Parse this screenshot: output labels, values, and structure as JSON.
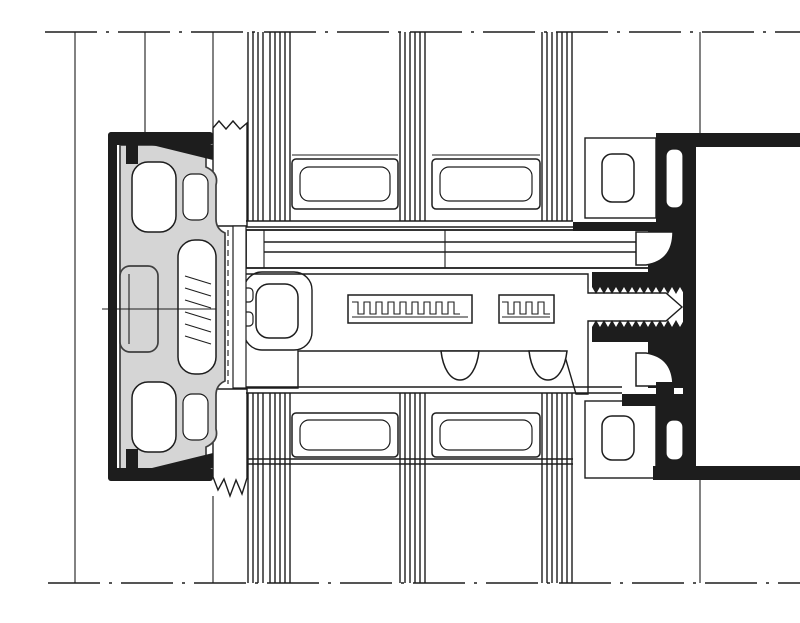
{
  "diagram": {
    "type": "technical-section-detail",
    "subject": "Curtain-wall facade transom cross-section detail: triple glazing units with edge spacers, EPDM gaskets, screwed pressure plate with exterior cover cap, hatched thermal-break insulator and black aluminium mullion profile",
    "orientation": "exterior at left, interior at right, glazing above and below",
    "text_labels": []
  },
  "colors": {
    "background": "#ffffff",
    "line": "#1d1d1d",
    "profile_fill": "#1d1d1d",
    "gasket_fill": "#d5d5d5",
    "gasket_outline": "#3f3f3f"
  },
  "components": [
    {
      "id": "break-line-top",
      "label": "Section break line (top)"
    },
    {
      "id": "break-line-bottom",
      "label": "Section break line (bottom)"
    },
    {
      "id": "reference-line-outer",
      "label": "Reference line, exterior plane"
    },
    {
      "id": "reference-line-cap",
      "label": "Reference line, cover cap plane"
    },
    {
      "id": "jamb-line-left",
      "label": "Glazing edge line, exterior"
    },
    {
      "id": "interior-face-line",
      "label": "Interior face line of mullion"
    },
    {
      "id": "centerline-interior",
      "label": "Dashed interior reference line"
    },
    {
      "id": "upper-glazing-unit",
      "label": "Upper triple-glazing unit with two edge spacers"
    },
    {
      "id": "lower-glazing-unit",
      "label": "Lower triple-glazing unit with two edge spacers"
    },
    {
      "id": "exterior-gasket-top",
      "label": "Exterior glazing gasket (hatched), upper"
    },
    {
      "id": "exterior-gasket-bottom",
      "label": "Exterior glazing gasket (hatched), lower"
    },
    {
      "id": "interior-gasket-top",
      "label": "Interior glazing gasket with hollow chamber, upper"
    },
    {
      "id": "interior-gasket-bottom",
      "label": "Interior glazing gasket with hollow chamber, lower"
    },
    {
      "id": "cover-cap-shell",
      "label": "Exterior cover cap shell (black outline profile)"
    },
    {
      "id": "cover-cap-body",
      "label": "Cover cap / clip body (grey extrusion with chambers)"
    },
    {
      "id": "fixing-screw",
      "label": "Pressure-plate fixing screw with threaded channel"
    },
    {
      "id": "pressure-plate",
      "label": "Pressure plate and glazing carrier bars"
    },
    {
      "id": "thermal-break-insulator",
      "label": "Thermal break insulator bar (cross-hatched) with arrow tongue"
    },
    {
      "id": "mullion-profile",
      "label": "Aluminium mullion/transom profile (solid black)"
    }
  ]
}
